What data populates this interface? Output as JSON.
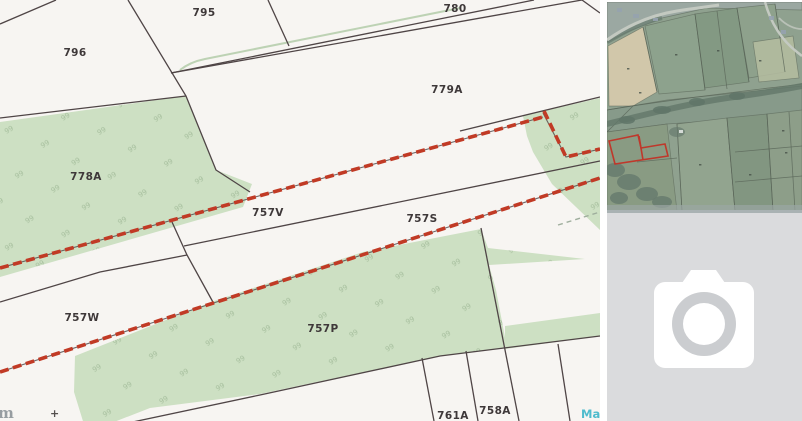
{
  "map": {
    "type": "cadastral-title-plan",
    "parcels": [
      {
        "id": "796"
      },
      {
        "id": "795"
      },
      {
        "id": "780"
      },
      {
        "id": "779A"
      },
      {
        "id": "778A"
      },
      {
        "id": "757V"
      },
      {
        "id": "757S"
      },
      {
        "id": "757W"
      },
      {
        "id": "757P"
      },
      {
        "id": "761A"
      },
      {
        "id": "758A"
      }
    ],
    "veg_glyph": "99",
    "fragments": {
      "bottom_left_text": "m",
      "bottom_left_mark": "+",
      "bottom_right_text": "Ma"
    },
    "colors": {
      "background": "#f7f5f2",
      "parcel_green": "#cde0c3",
      "boundary_line": "#4f4546",
      "boundary_red": "#c13a25",
      "hedge_green": "#bdd2b4",
      "watermark_teal": "#4fbccd"
    }
  },
  "side_panel": {
    "aerial_thumbnail": {
      "icon": "aerial-photo-thumbnail",
      "outline_red": "#c3281b"
    },
    "photo_placeholder": {
      "icon": "camera-icon",
      "background": "#dadbdd"
    }
  }
}
